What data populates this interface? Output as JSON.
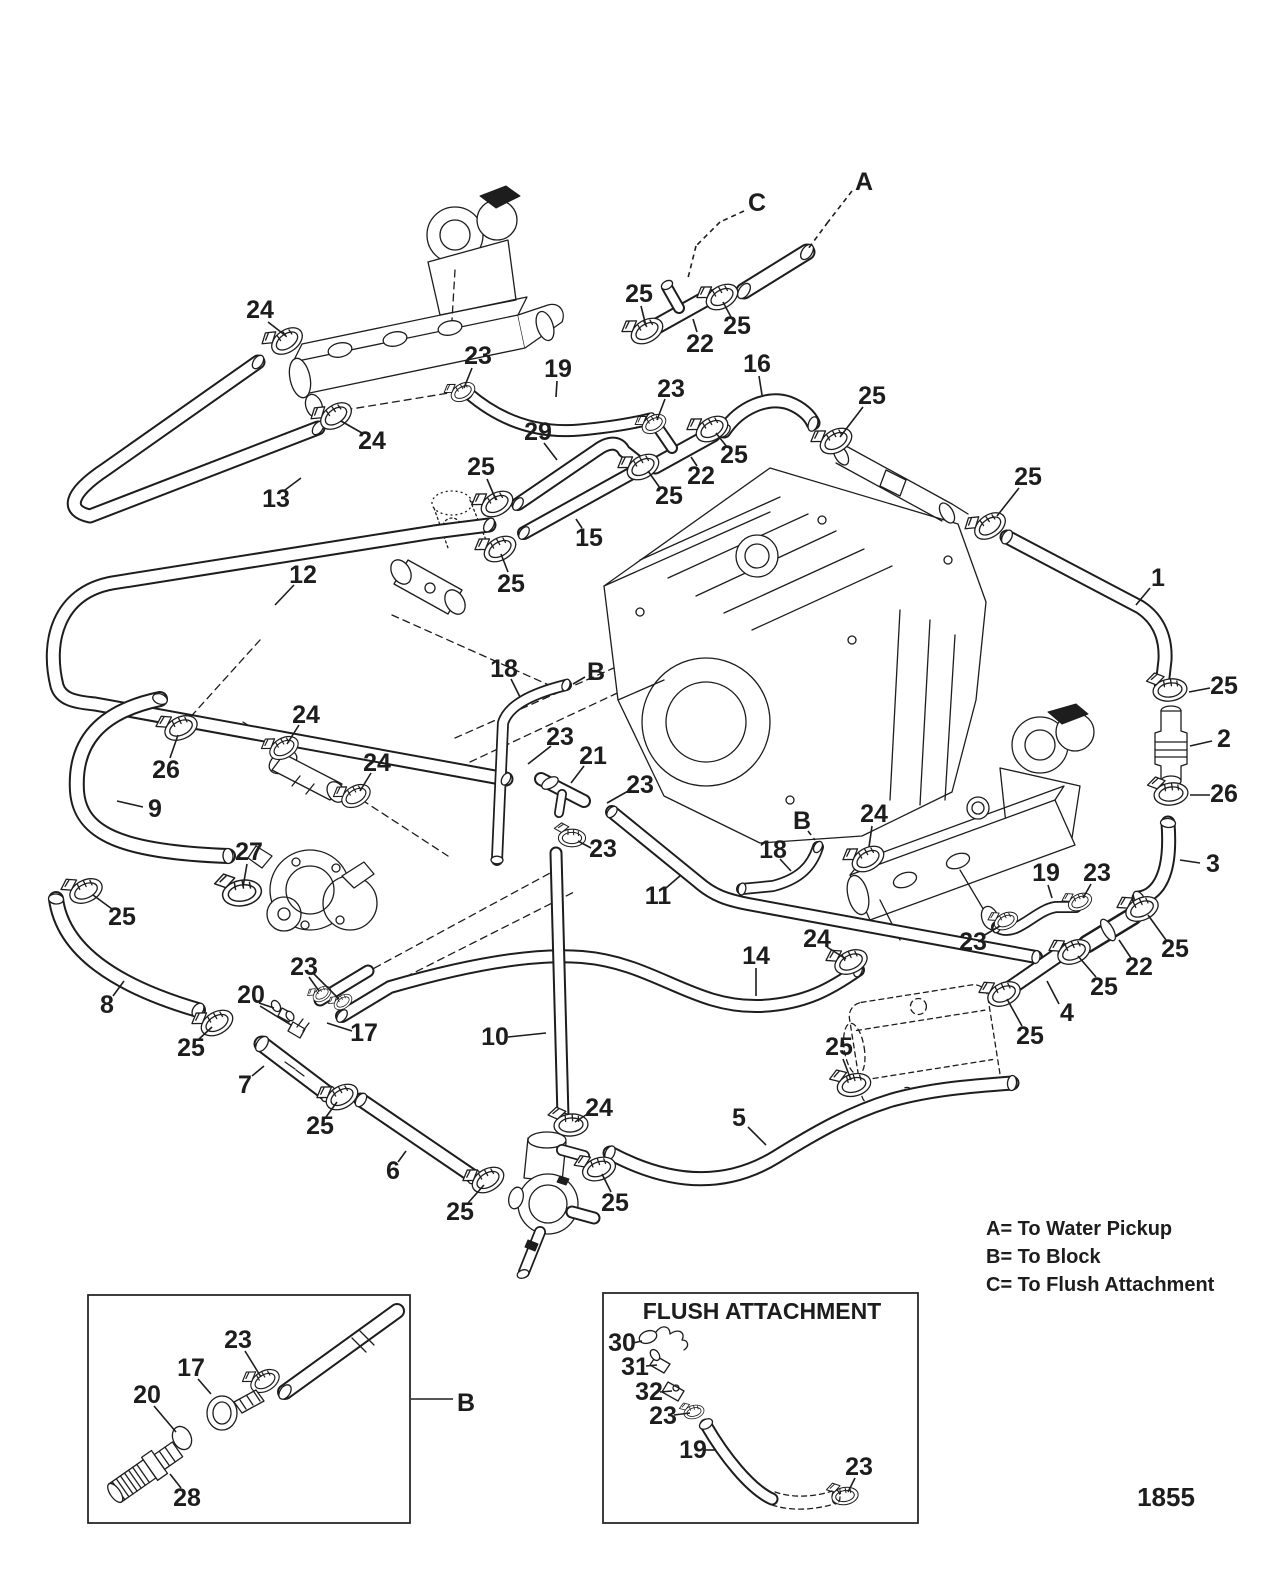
{
  "page": {
    "number": "1855",
    "ink": "#1d1d1d",
    "paper": "#ffffff"
  },
  "legend": {
    "items": [
      "A= To Water Pickup",
      "B= To Block",
      "C= To Flush Attachment"
    ]
  },
  "flush_box": {
    "title": "FLUSH ATTACHMENT"
  },
  "callouts": [
    {
      "label": "24",
      "x": 260,
      "y": 310,
      "lines": [
        [
          268,
          322,
          286,
          336
        ]
      ]
    },
    {
      "label": "24",
      "x": 372,
      "y": 441,
      "lines": [
        [
          362,
          433,
          341,
          421
        ]
      ]
    },
    {
      "label": "23",
      "x": 478,
      "y": 356,
      "lines": [
        [
          472,
          368,
          464,
          388
        ]
      ]
    },
    {
      "label": "19",
      "x": 558,
      "y": 369,
      "lines": [
        [
          557,
          381,
          556,
          397
        ]
      ]
    },
    {
      "label": "29",
      "x": 538,
      "y": 432,
      "lines": [
        [
          544,
          443,
          557,
          460
        ]
      ]
    },
    {
      "label": "25",
      "x": 481,
      "y": 467,
      "lines": [
        [
          487,
          479,
          496,
          500
        ]
      ]
    },
    {
      "label": "25",
      "x": 511,
      "y": 584,
      "lines": [
        [
          508,
          572,
          501,
          554
        ]
      ]
    },
    {
      "label": "13",
      "x": 276,
      "y": 499,
      "lines": [
        [
          285,
          490,
          301,
          478
        ]
      ]
    },
    {
      "label": "12",
      "x": 303,
      "y": 575,
      "lines": [
        [
          294,
          585,
          275,
          605
        ]
      ]
    },
    {
      "label": "C",
      "x": 757,
      "y": 203,
      "dash": true,
      "lines": [
        [
          744,
          211,
          720,
          222
        ],
        [
          720,
          222,
          696,
          246
        ],
        [
          696,
          246,
          688,
          278
        ]
      ]
    },
    {
      "label": "A",
      "x": 864,
      "y": 182,
      "dash": true,
      "lines": [
        [
          852,
          191,
          828,
          222
        ],
        [
          828,
          222,
          808,
          249
        ]
      ]
    },
    {
      "label": "25",
      "x": 639,
      "y": 294,
      "lines": [
        [
          641,
          306,
          646,
          326
        ]
      ]
    },
    {
      "label": "22",
      "x": 700,
      "y": 344,
      "lines": [
        [
          697,
          332,
          693,
          319
        ]
      ]
    },
    {
      "label": "25",
      "x": 737,
      "y": 326,
      "lines": [
        [
          731,
          317,
          723,
          302
        ]
      ]
    },
    {
      "label": "16",
      "x": 757,
      "y": 364,
      "lines": [
        [
          759,
          376,
          762,
          395
        ]
      ]
    },
    {
      "label": "23",
      "x": 671,
      "y": 389,
      "lines": [
        [
          665,
          399,
          657,
          420
        ]
      ]
    },
    {
      "label": "25",
      "x": 734,
      "y": 455,
      "lines": [
        [
          727,
          447,
          716,
          433
        ]
      ]
    },
    {
      "label": "22",
      "x": 701,
      "y": 476,
      "lines": [
        [
          697,
          466,
          691,
          457
        ]
      ]
    },
    {
      "label": "25",
      "x": 669,
      "y": 496,
      "lines": [
        [
          660,
          488,
          648,
          471
        ]
      ]
    },
    {
      "label": "15",
      "x": 589,
      "y": 538,
      "lines": [
        [
          582,
          528,
          576,
          519
        ]
      ]
    },
    {
      "label": "25",
      "x": 872,
      "y": 396,
      "lines": [
        [
          863,
          407,
          840,
          437
        ]
      ]
    },
    {
      "label": "25",
      "x": 1028,
      "y": 477,
      "lines": [
        [
          1019,
          488,
          997,
          516
        ]
      ]
    },
    {
      "label": "1",
      "x": 1158,
      "y": 578,
      "lines": [
        [
          1150,
          588,
          1136,
          605
        ]
      ]
    },
    {
      "label": "25",
      "x": 1224,
      "y": 686,
      "lines": [
        [
          1210,
          688,
          1189,
          692
        ]
      ]
    },
    {
      "label": "2",
      "x": 1224,
      "y": 739,
      "lines": [
        [
          1212,
          741,
          1190,
          746
        ]
      ]
    },
    {
      "label": "26",
      "x": 1224,
      "y": 794,
      "lines": [
        [
          1210,
          795,
          1190,
          795
        ]
      ]
    },
    {
      "label": "3",
      "x": 1213,
      "y": 864,
      "lines": [
        [
          1200,
          863,
          1180,
          860
        ]
      ]
    },
    {
      "label": "24",
      "x": 874,
      "y": 814,
      "lines": [
        [
          872,
          826,
          869,
          847
        ]
      ]
    },
    {
      "label": "B",
      "x": 802,
      "y": 821,
      "dash": true,
      "lines": [
        [
          808,
          831,
          815,
          840
        ]
      ]
    },
    {
      "label": "18",
      "x": 773,
      "y": 850,
      "lines": [
        [
          780,
          859,
          791,
          871
        ]
      ]
    },
    {
      "label": "24",
      "x": 817,
      "y": 939,
      "lines": [
        [
          827,
          947,
          846,
          959
        ]
      ]
    },
    {
      "label": "19",
      "x": 1046,
      "y": 873,
      "lines": [
        [
          1048,
          885,
          1052,
          898
        ]
      ]
    },
    {
      "label": "23",
      "x": 1097,
      "y": 873,
      "lines": [
        [
          1091,
          884,
          1083,
          898
        ]
      ]
    },
    {
      "label": "23",
      "x": 973,
      "y": 942,
      "lines": [
        [
          983,
          936,
          1000,
          926
        ]
      ]
    },
    {
      "label": "22",
      "x": 1139,
      "y": 967,
      "lines": [
        [
          1131,
          958,
          1119,
          940
        ]
      ]
    },
    {
      "label": "25",
      "x": 1175,
      "y": 949,
      "lines": [
        [
          1166,
          940,
          1148,
          915
        ]
      ]
    },
    {
      "label": "25",
      "x": 1104,
      "y": 987,
      "lines": [
        [
          1096,
          977,
          1078,
          956
        ]
      ]
    },
    {
      "label": "4",
      "x": 1067,
      "y": 1013,
      "lines": [
        [
          1059,
          1004,
          1047,
          981
        ]
      ]
    },
    {
      "label": "25",
      "x": 1030,
      "y": 1036,
      "lines": [
        [
          1022,
          1026,
          1007,
          999
        ]
      ]
    },
    {
      "label": "25",
      "x": 839,
      "y": 1047,
      "lines": [
        [
          843,
          1059,
          851,
          1080
        ]
      ]
    },
    {
      "label": "14",
      "x": 756,
      "y": 956,
      "lines": [
        [
          756,
          968,
          756,
          996
        ]
      ]
    },
    {
      "label": "5",
      "x": 739,
      "y": 1118,
      "lines": [
        [
          748,
          1127,
          766,
          1145
        ]
      ]
    },
    {
      "label": "11",
      "x": 658,
      "y": 896,
      "lines": [
        [
          666,
          888,
          681,
          875
        ]
      ]
    },
    {
      "label": "18",
      "x": 504,
      "y": 669,
      "lines": [
        [
          511,
          679,
          520,
          697
        ]
      ]
    },
    {
      "label": "B",
      "x": 596,
      "y": 672,
      "lines": [
        [
          585,
          677,
          573,
          684
        ]
      ]
    },
    {
      "label": "23",
      "x": 560,
      "y": 737,
      "lines": [
        [
          551,
          746,
          528,
          764
        ]
      ]
    },
    {
      "label": "21",
      "x": 593,
      "y": 756,
      "lines": [
        [
          584,
          766,
          571,
          783
        ]
      ]
    },
    {
      "label": "23",
      "x": 640,
      "y": 785,
      "lines": [
        [
          630,
          790,
          607,
          803
        ]
      ]
    },
    {
      "label": "23",
      "x": 603,
      "y": 849,
      "lines": [
        [
          591,
          848,
          578,
          841
        ]
      ]
    },
    {
      "label": "10",
      "x": 495,
      "y": 1037,
      "lines": [
        [
          508,
          1037,
          546,
          1033
        ]
      ]
    },
    {
      "label": "24",
      "x": 599,
      "y": 1108,
      "lines": [
        [
          589,
          1113,
          575,
          1122
        ]
      ]
    },
    {
      "label": "25",
      "x": 460,
      "y": 1212,
      "lines": [
        [
          468,
          1203,
          484,
          1185
        ]
      ]
    },
    {
      "label": "25",
      "x": 615,
      "y": 1203,
      "lines": [
        [
          611,
          1192,
          602,
          1174
        ]
      ]
    },
    {
      "label": "6",
      "x": 393,
      "y": 1171,
      "lines": [
        [
          398,
          1162,
          406,
          1151
        ]
      ]
    },
    {
      "label": "25",
      "x": 320,
      "y": 1126,
      "lines": [
        [
          326,
          1117,
          337,
          1102
        ]
      ]
    },
    {
      "label": "7",
      "x": 245,
      "y": 1085,
      "lines": [
        [
          252,
          1076,
          264,
          1066
        ]
      ]
    },
    {
      "label": "8",
      "x": 107,
      "y": 1005,
      "lines": [
        [
          113,
          996,
          124,
          981
        ]
      ]
    },
    {
      "label": "25",
      "x": 191,
      "y": 1048,
      "lines": [
        [
          198,
          1040,
          212,
          1027
        ]
      ]
    },
    {
      "label": "25",
      "x": 122,
      "y": 917,
      "lines": [
        [
          112,
          909,
          93,
          895
        ]
      ]
    },
    {
      "label": "27",
      "x": 249,
      "y": 852,
      "lines": [
        [
          247,
          864,
          243,
          887
        ]
      ]
    },
    {
      "label": "26",
      "x": 166,
      "y": 770,
      "lines": [
        [
          170,
          758,
          178,
          735
        ]
      ]
    },
    {
      "label": "9",
      "x": 155,
      "y": 809,
      "lines": [
        [
          143,
          807,
          117,
          801
        ]
      ]
    },
    {
      "label": "24",
      "x": 306,
      "y": 715,
      "lines": [
        [
          299,
          725,
          287,
          744
        ]
      ]
    },
    {
      "label": "24",
      "x": 377,
      "y": 763,
      "lines": [
        [
          371,
          773,
          360,
          791
        ]
      ]
    },
    {
      "label": "23",
      "x": 304,
      "y": 967,
      "lines": [
        [
          309,
          977,
          319,
          991
        ],
        [
          313,
          973,
          339,
          999
        ]
      ]
    },
    {
      "label": "20",
      "x": 251,
      "y": 995,
      "lines": [
        [
          259,
          1003,
          274,
          1008
        ],
        [
          260,
          1006,
          291,
          1025
        ]
      ]
    },
    {
      "label": "17",
      "x": 364,
      "y": 1033,
      "lines": [
        [
          352,
          1031,
          327,
          1023
        ]
      ]
    },
    {
      "label": "23",
      "x": 238,
      "y": 1340,
      "lines": [
        [
          245,
          1351,
          261,
          1377
        ]
      ]
    },
    {
      "label": "17",
      "x": 191,
      "y": 1368,
      "lines": [
        [
          198,
          1379,
          211,
          1394
        ]
      ]
    },
    {
      "label": "20",
      "x": 147,
      "y": 1395,
      "lines": [
        [
          154,
          1406,
          176,
          1432
        ]
      ]
    },
    {
      "label": "28",
      "x": 187,
      "y": 1498,
      "lines": [
        [
          181,
          1488,
          170,
          1474
        ]
      ]
    },
    {
      "label": "B",
      "x": 466,
      "y": 1403,
      "lines": [
        [
          453,
          1399,
          411,
          1399
        ]
      ]
    },
    {
      "label": "30",
      "x": 622,
      "y": 1343,
      "lines": [
        [
          633,
          1343,
          642,
          1341
        ]
      ]
    },
    {
      "label": "31",
      "x": 635,
      "y": 1367,
      "lines": [
        [
          646,
          1366,
          657,
          1365
        ]
      ]
    },
    {
      "label": "32",
      "x": 649,
      "y": 1392,
      "lines": [
        [
          660,
          1392,
          672,
          1391
        ]
      ]
    },
    {
      "label": "23",
      "x": 663,
      "y": 1416,
      "lines": [
        [
          674,
          1415,
          690,
          1413
        ]
      ]
    },
    {
      "label": "19",
      "x": 693,
      "y": 1450,
      "lines": [
        [
          704,
          1450,
          715,
          1450
        ]
      ]
    },
    {
      "label": "23",
      "x": 859,
      "y": 1467,
      "lines": [
        [
          855,
          1478,
          848,
          1492
        ]
      ]
    }
  ]
}
